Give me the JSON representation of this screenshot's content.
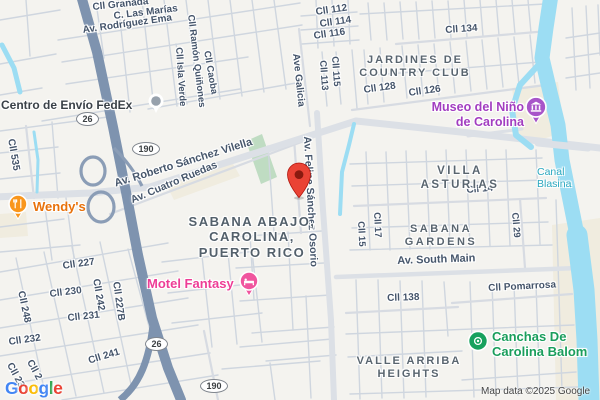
{
  "map": {
    "attribution": "Map data ©2025 Google",
    "logo": [
      "G",
      "o",
      "o",
      "g",
      "l",
      "e"
    ]
  },
  "neighborhoods": {
    "jardines": "JARDINES DE\nCOUNTRY CLUB",
    "villa_asturias": "VILLA ASTURIAS",
    "sabana_gardens": "SABANA\nGARDENS",
    "valle_arriba": "VALLE ARRIBA\nHEIGHTS",
    "sabana_abajo": "SABANA ABAJO,\nCAROLINA,\nPUERTO RICO"
  },
  "streets": {
    "cll_granada": "Cll Granada",
    "c_las_marias": "C. Las Marías",
    "av_rodriguez_ema": "Av. Rodríguez Ema",
    "cll_ramon_quinones": "Cll Ramón Quiñones",
    "cll_isla_verde": "Cll Isla Verde",
    "cll_caoba": "Cll Caoba",
    "cll_535": "Cll 535",
    "cll_112": "Cll 112",
    "cll_114": "Cll 114",
    "cll_116": "Cll 116",
    "ave_galicia": "Ave Galicia",
    "cll_115": "Cll 115",
    "cll_113": "Cll 113",
    "cll_134": "Cll 134",
    "cll_128": "Cll 128",
    "cll_126": "Cll 126",
    "av_roberto": "Av. Roberto Sánchez Vilella",
    "av_cuatro": "Av. Cuatro Ruedas",
    "av_felipe": "Av. Felipe Sánchez Osorio",
    "cll_14": "Cll 14",
    "cll_15": "Cll 15",
    "cll_17": "Cll 17",
    "cll_29": "Cll 29",
    "av_south_main": "Av. South Main",
    "cll_pomarrosa": "Cll Pomarrosa",
    "cll_138": "Cll 138",
    "cll_227": "Cll 227",
    "cll_230": "Cll 230",
    "cll_242": "Cll 242",
    "cll_227b": "Cll 227B",
    "cll_248": "Cll 248",
    "cll_231": "Cll 231",
    "cll_232": "Cll 232",
    "cll_241": "Cll 241",
    "cll_23_partial": "Cll 23",
    "cll_2_partial": "Cll 2"
  },
  "water": {
    "canal_blasina": "Canal Blasina"
  },
  "pois": {
    "fedex": {
      "label": "Centro de Envío FedEx",
      "icon": "place-dot",
      "color": "#97A1AC"
    },
    "wendys": {
      "label": "Wendy's",
      "icon": "restaurant",
      "color": "#F9961C"
    },
    "motel": {
      "label": "Motel Fantasy",
      "icon": "lodging",
      "color": "#F0559E"
    },
    "museo": {
      "label": "Museo del Niño\nde Carolina",
      "icon": "museum",
      "color": "#A855C9"
    },
    "canchas": {
      "label": "Canchas De\nCarolina Balom",
      "icon": "sports",
      "color": "#17A15D"
    }
  },
  "shields": {
    "hwy26_north": "26",
    "hwy190_north": "190",
    "hwy26_south": "26",
    "hwy190_south": "190"
  },
  "marker": {
    "type": "destination-marker",
    "color": "#EA4335"
  },
  "colors": {
    "marker_red": "#EA4335",
    "water": "#9CDDF3",
    "highway": "#7E93AF",
    "road_major": "#DCE0E6",
    "road_minor": "#CFD6DF",
    "sand": "#F0ECDF",
    "park_green": "#BFDCC2",
    "poi_text_orange": "#E8710A",
    "poi_text_pink": "#EE3D96",
    "poi_text_purple": "#A23DC0",
    "poi_text_green": "#1A9E5C",
    "canal_label_teal": "#2BA8BF"
  }
}
